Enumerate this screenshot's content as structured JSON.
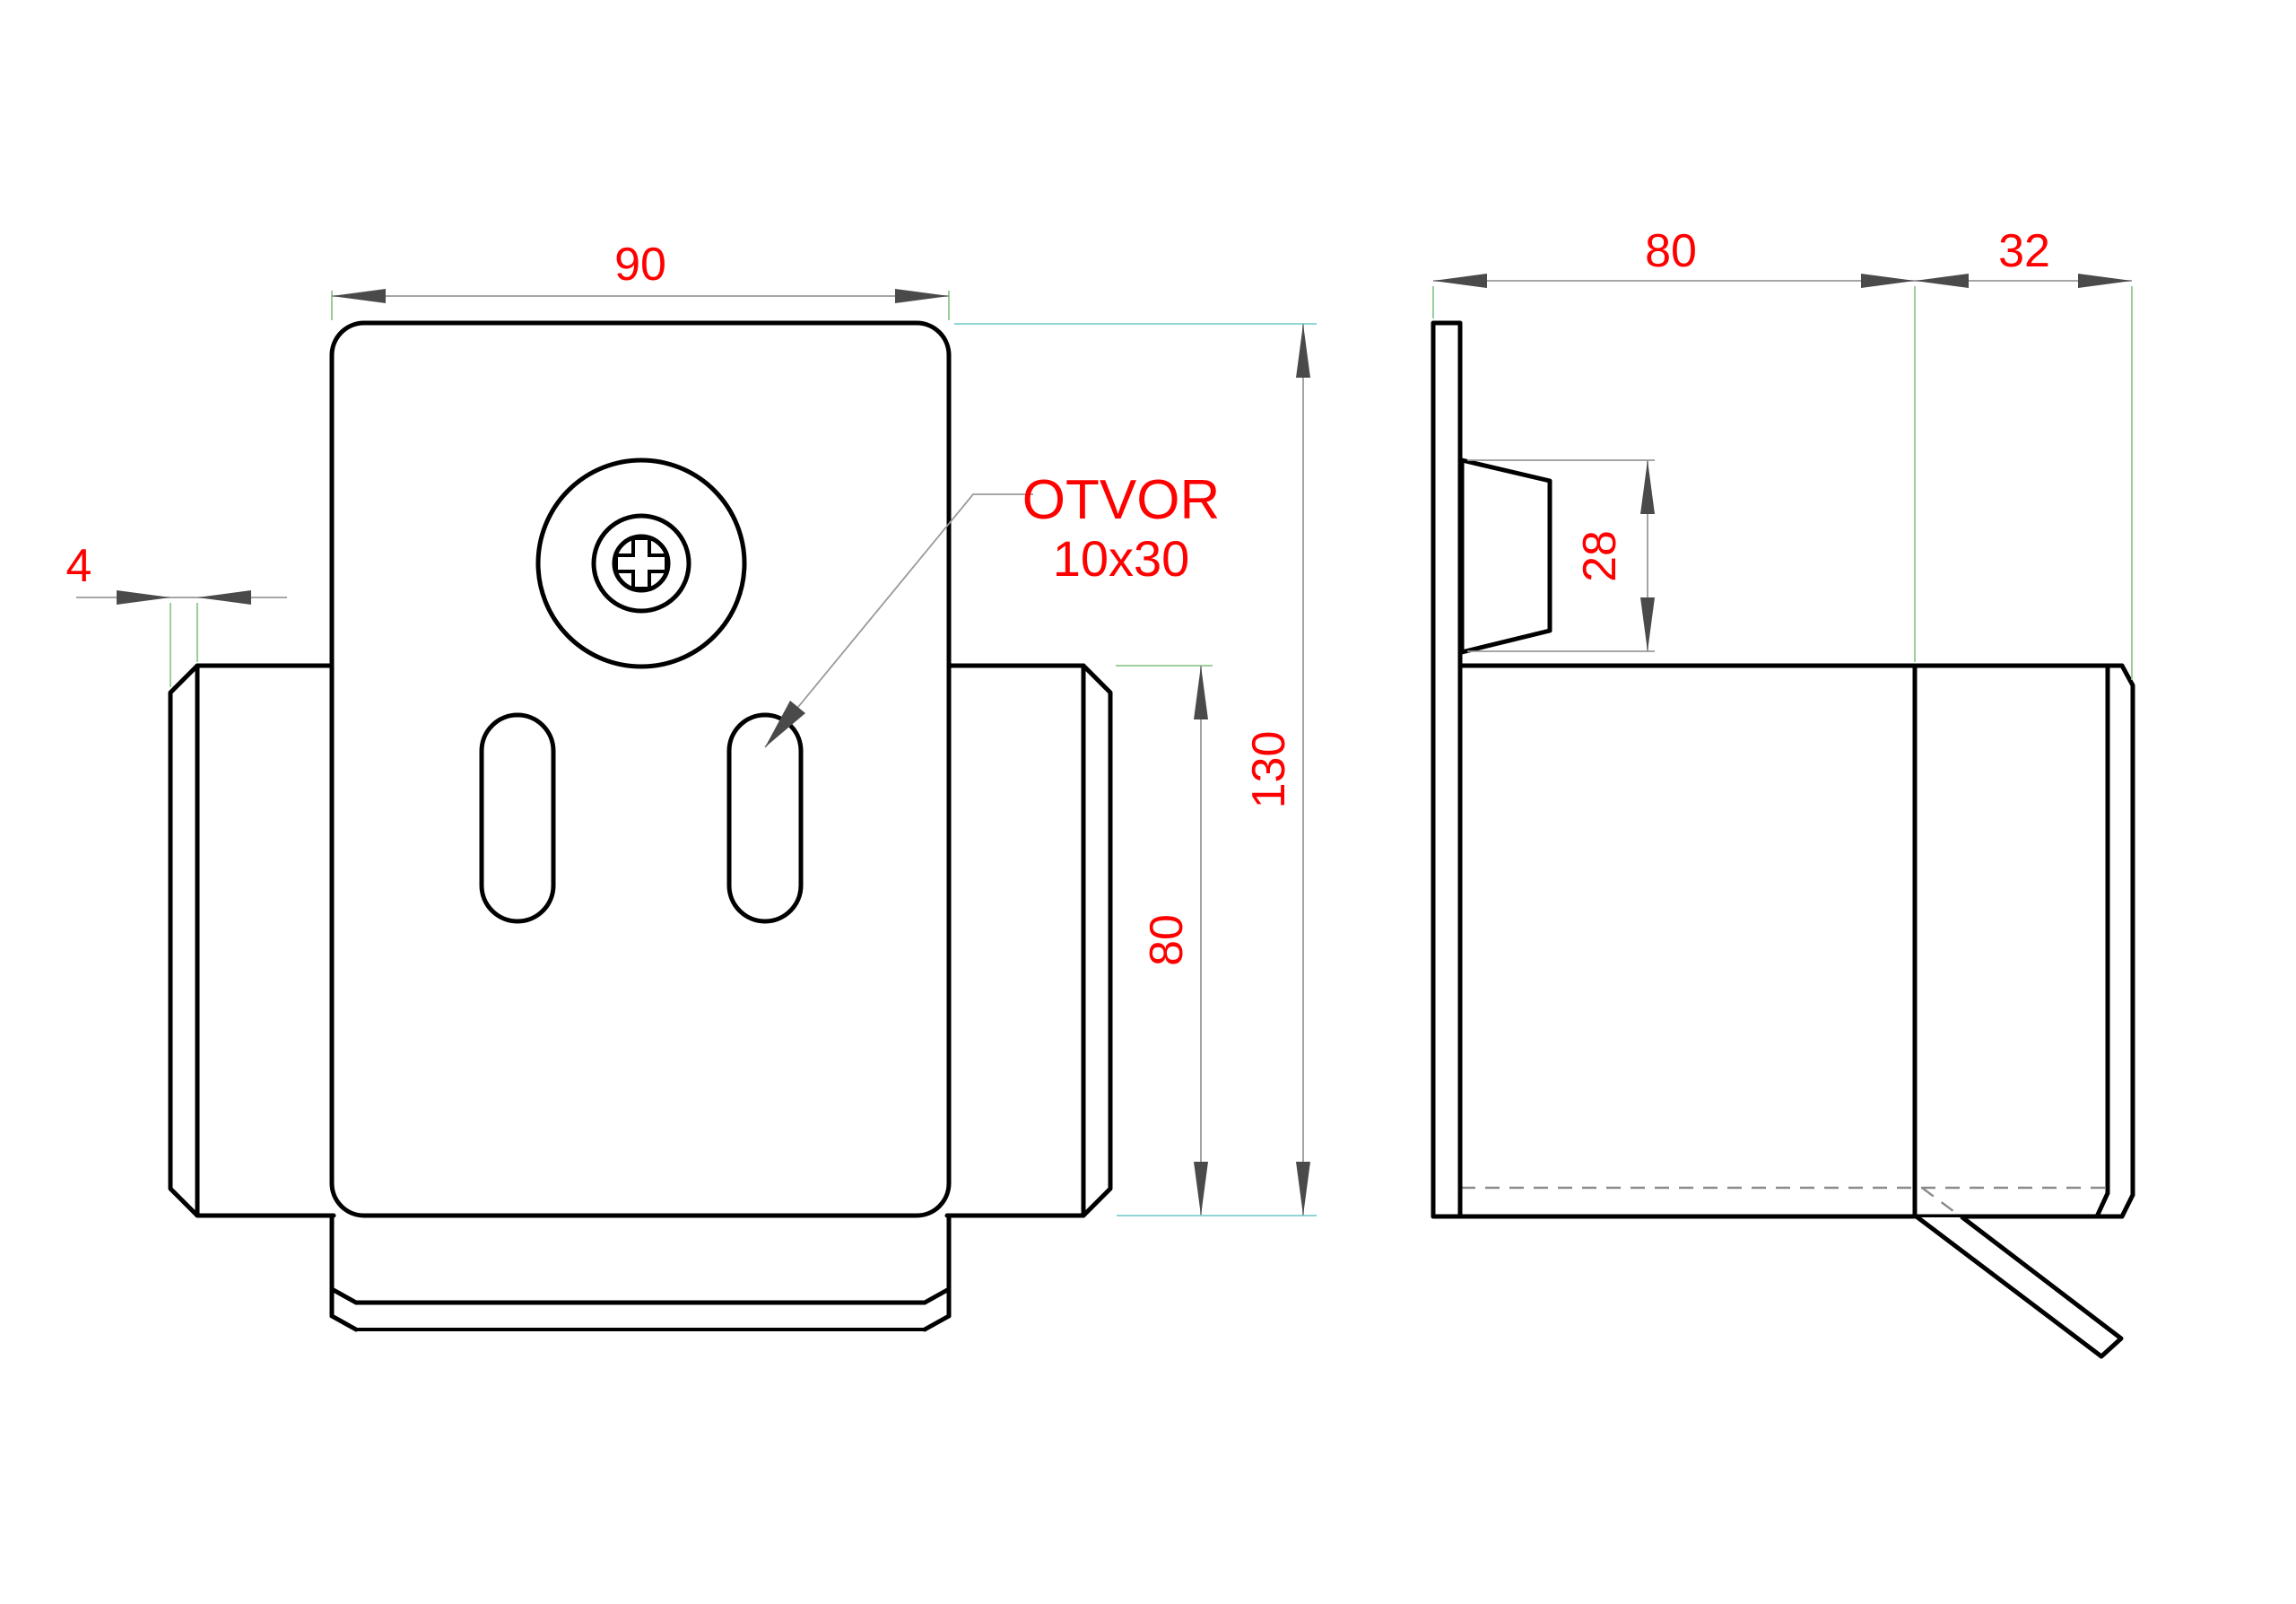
{
  "drawing": {
    "type": "technical-drawing-two-views",
    "part": "sheet-metal mounting bracket",
    "front_view": {
      "dim_width": "90",
      "dim_flange_thickness": "4",
      "dim_flange_height": "80",
      "dim_total_height": "130",
      "callout_line1": "OTVOR",
      "callout_line2": "10x30"
    },
    "side_view": {
      "dim_depth": "80",
      "dim_flap": "32",
      "dim_boss_height": "28"
    },
    "colors": {
      "background": "#ffffff",
      "outline": "#000000",
      "dimension_text": "#ff0000",
      "dimension_line": "#9a9a9a",
      "arrowhead": "#4a4a4a",
      "extension_line_green": "#8fc98f",
      "extension_line_cyan": "#7fd0d0",
      "hidden_line": "#8a8a8a"
    }
  }
}
